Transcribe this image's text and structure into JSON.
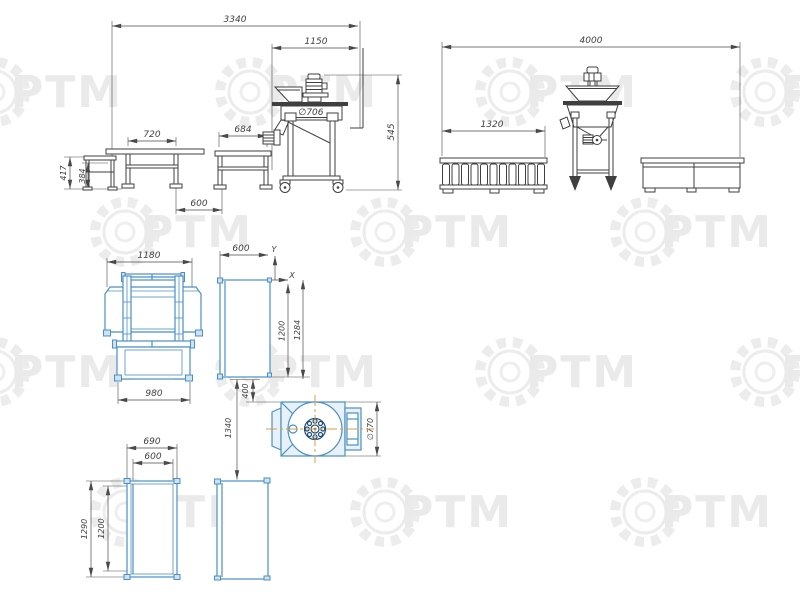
{
  "watermark": {
    "text": "РТМ"
  },
  "colors": {
    "line": "#3f3f3f",
    "plan_blue": "#4a90c4",
    "flange_navy": "#1f4e79",
    "centerline_orange": "#d79b4a",
    "watermark_gray": "#ececec"
  },
  "views": {
    "side": {
      "overall": "3340",
      "machine_section": "1150",
      "table1_span": "720",
      "table2_span": "684",
      "gap": "600",
      "machine_height": "545",
      "platform_height": "417",
      "table_height": "384",
      "tank_diameter": "∅706"
    },
    "front": {
      "overall": "4000",
      "rack_width": "1320"
    },
    "plan": {
      "table1_width": "1180",
      "table1_base": "980",
      "table2_width": "600",
      "table2_length": "1200",
      "table2_length_overall": "1284",
      "gap": "400",
      "offset": "1340",
      "rotor_diameter": "∅770",
      "axis_x": "X",
      "axis_y": "Y"
    },
    "plan_lower": {
      "overall_width": "690",
      "inner_width": "600",
      "overall_length": "1290",
      "inner_length": "1200"
    }
  }
}
